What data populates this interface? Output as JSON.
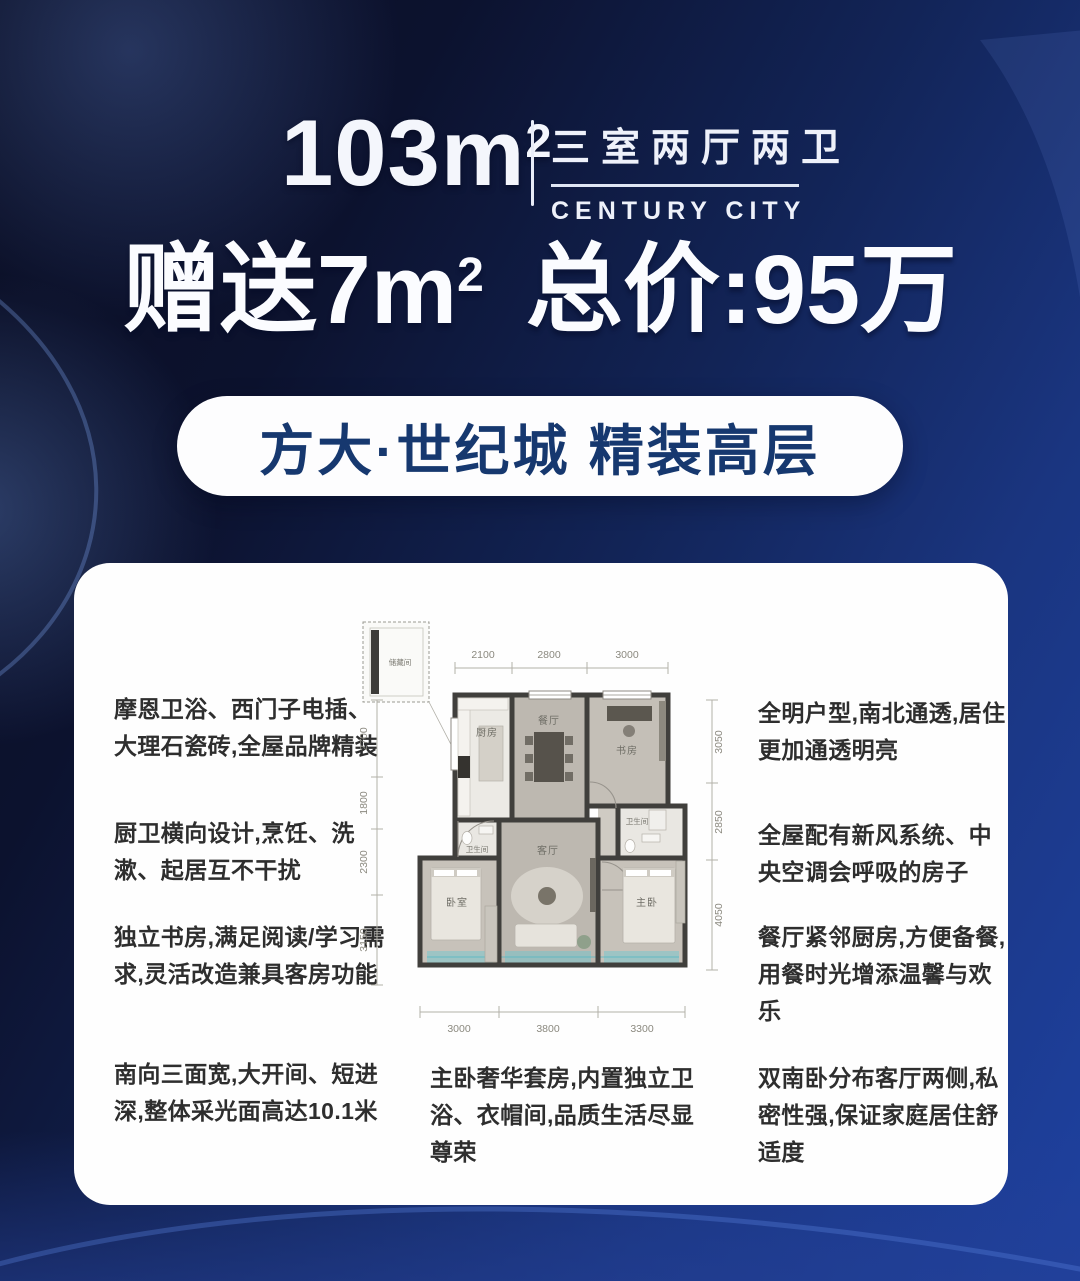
{
  "colors": {
    "bg_dark": "#0a0e24",
    "bg_blue": "#1e41a0",
    "card_bg": "#fefefe",
    "pill_text_navy": "#16386f",
    "headline_white": "#fbfcff",
    "plan_teal": "#5ec8d4"
  },
  "header": {
    "area_value": "103m",
    "area_sup": "2",
    "layout_cn": "三室两厅两卫",
    "brand_en": "CENTURY CITY"
  },
  "headline": {
    "gift": "赠送7m",
    "gift_sup": "2",
    "price": "总价:95万"
  },
  "banner": {
    "label": "方大·世纪城 精装高层"
  },
  "features": {
    "left": [
      "摩恩卫浴、西门子电插、大理石瓷砖,全屋品牌精装",
      "厨卫横向设计,烹饪、洗漱、起居互不干扰",
      "独立书房,满足阅读/学习需求,灵活改造兼具客房功能"
    ],
    "right": [
      "全明户型,南北通透,居住更加通透明亮",
      "全屋配有新风系统、中央空调会呼吸的房子",
      "餐厅紧邻厨房,方便备餐,用餐时光增添温馨与欢乐"
    ],
    "bottom": [
      "南向三面宽,大开间、短进深,整体采光面高达10.1米",
      "主卧奢华套房,内置独立卫浴、衣帽间,品质生活尽显尊荣",
      "双南卧分布客厅两侧,私密性强,保证家庭居住舒适度"
    ]
  },
  "floorplan": {
    "storage_label": "储藏间",
    "dims_top": [
      "2100",
      "2800",
      "3000"
    ],
    "dims_left": [
      "2700",
      "1800",
      "2300",
      "3150"
    ],
    "dims_right": [
      "3050",
      "2850",
      "4050"
    ],
    "dims_bottom": [
      "3000",
      "3800",
      "3300"
    ],
    "rooms": {
      "kitchen": "厨房",
      "dining": "餐厅",
      "study": "书房",
      "living": "客厅",
      "bedroom": "卧室",
      "master": "主卧",
      "bath1": "卫生间",
      "bath2": "卫生间"
    }
  }
}
